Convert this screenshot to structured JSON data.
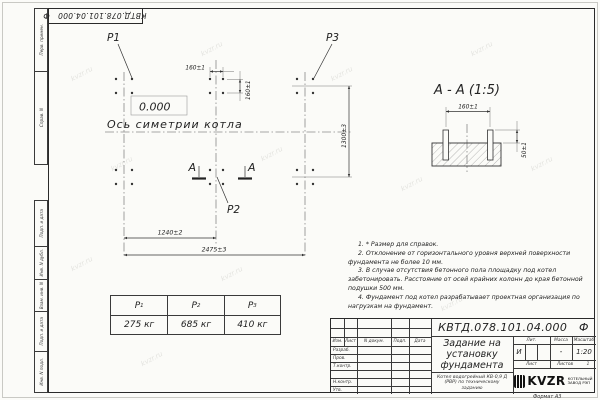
{
  "page": {
    "corner_designation": "КВТД.078.101.04.000   Ф",
    "format_label": "Формат А3",
    "watermark": "kvzr.ru"
  },
  "margin_labels": {
    "perv": "Перв. примен.",
    "sprav": "Справ. N",
    "podp1": "Подп. и дата",
    "inv_dubl": "Инв. N дубл.",
    "vzam": "Взам. инв. N",
    "podp2": "Подп. и дата",
    "inv_podl": "Инв. N подл."
  },
  "plan": {
    "p1": "P1",
    "p2": "P2",
    "p3": "P3",
    "elevation": "0.000",
    "axis_label": "Ось симетрии котла",
    "dim_160h": "160±1",
    "dim_160v": "160±1",
    "dim_1240": "1240±2",
    "dim_2475": "2475±3",
    "dim_1300": "1300±3",
    "section_letter_left": "А",
    "section_letter_right": "А"
  },
  "section": {
    "title": "А - А (1:5)",
    "dim_160": "160±1",
    "dim_50": "50±1"
  },
  "loads_table": {
    "cols": [
      {
        "name": "P",
        "sub": "1",
        "value": "275 кг"
      },
      {
        "name": "P",
        "sub": "2",
        "value": "685 кг"
      },
      {
        "name": "P",
        "sub": "3",
        "value": "410 кг"
      }
    ]
  },
  "notes": {
    "items": [
      "1. * Размер для справок.",
      "2. Отклонение от горизонтального уровня верхней поверхности фундамента не более 10 мм.",
      "3. В случае отсутствия бетонного пола площадку под котел забетонировать. Расстояние от осей крайних колонн до края бетонной подушки 500 мм.",
      "4. Фундамент под котел разрабатывает проектная организация по нагрузкам на фундамент."
    ]
  },
  "title_block": {
    "designation": "КВТД.078.101.04.000   Ф",
    "doc_title": "Задание на установку фундамента",
    "doc_subtitle": "Котел водогрейный КВ-0,9 Д (РВР) по техническому заданию",
    "change_cols": [
      "Изм.",
      "Лист",
      "N докум.",
      "Подп.",
      "Дата"
    ],
    "rows": [
      "Разраб.",
      "Пров.",
      "Т.контр.",
      "",
      "Н.контр.",
      "Утв."
    ],
    "lit_label": "Лит.",
    "lit_value": "И",
    "mass_label": "Масса",
    "mass_value": "-",
    "scale_label": "Масштаб",
    "scale_value": "1:20",
    "sheet_label": "Лист",
    "sheets_label": "Листов",
    "sheets_value": "1",
    "logo_text": "KVZR",
    "logo_caption": "КОТЕЛЬНЫЙ ЗАВОД РЭП"
  }
}
